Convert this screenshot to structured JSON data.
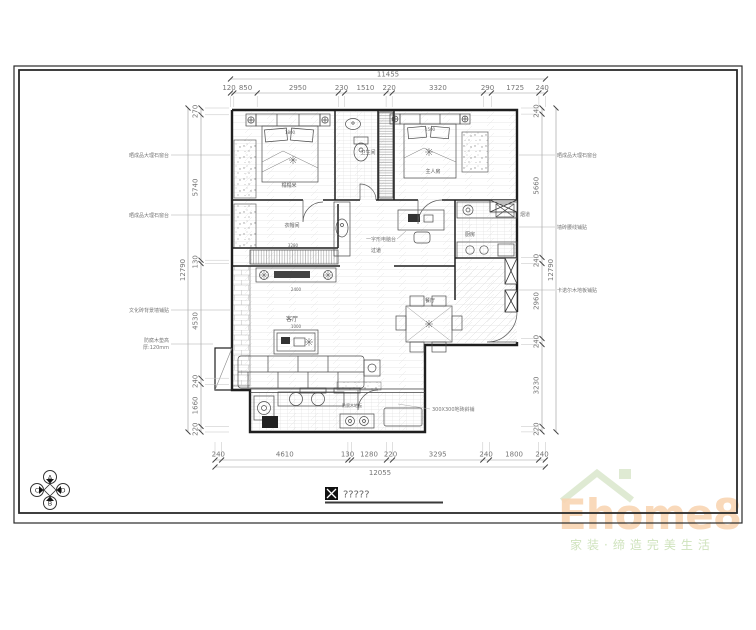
{
  "title_block": {
    "label": "?????"
  },
  "compass": {
    "top": "A",
    "bottom": "B",
    "left": "C",
    "right": "D"
  },
  "dims": {
    "top": {
      "total": "11455",
      "segments": [
        "120",
        "850",
        "2950",
        "230",
        "1510",
        "220",
        "3320",
        "290",
        "1725",
        "240"
      ]
    },
    "bottom": {
      "total": "12055",
      "segments": [
        "240",
        "4610",
        "130",
        "1280",
        "220",
        "3295",
        "240",
        "1800",
        "240"
      ]
    },
    "left": {
      "total": "12790",
      "segments": [
        "270",
        "5740",
        "130",
        "4530",
        "240",
        "1660",
        "220"
      ]
    },
    "right": {
      "total": "12790",
      "segments": [
        "240",
        "5660",
        "240",
        "2960",
        "240",
        "3230",
        "220"
      ]
    }
  },
  "rooms": {
    "bedroom1": "榻榻米",
    "bathroom": "卫生间",
    "bedroom2": "主人房",
    "cloakroom": "衣帽间",
    "hallway": "过道",
    "living": "客厅",
    "dining": "餐厅",
    "kitchen": "厨房",
    "balcony": "防腐木地板",
    "desk": "一字形电脑台"
  },
  "furniture": {
    "bed1": "1800",
    "bed2": "1500",
    "coffee_table": "1000",
    "tv_wall": "2400",
    "wardrobe": "3280"
  },
  "annotations": {
    "left": [
      "晒成品大理石窗台",
      "晒成品大理石窗台",
      "文化砖背景墙铺贴",
      "防腐木垫高",
      "厚:120mm"
    ],
    "right": [
      "晒成品大理石窗台",
      "墙砖腰线铺贴",
      "卡诺尔木地板铺贴",
      "烟道"
    ],
    "bottom": "300X300地砖斜铺"
  },
  "logo": {
    "brand": "Ehome8",
    "tagline": "家装·缔造完美生活"
  },
  "colors": {
    "wall": "#1f1f1f",
    "dim": "#757575",
    "logo_text": "#f8d5b2",
    "logo_green": "#dfead3"
  }
}
